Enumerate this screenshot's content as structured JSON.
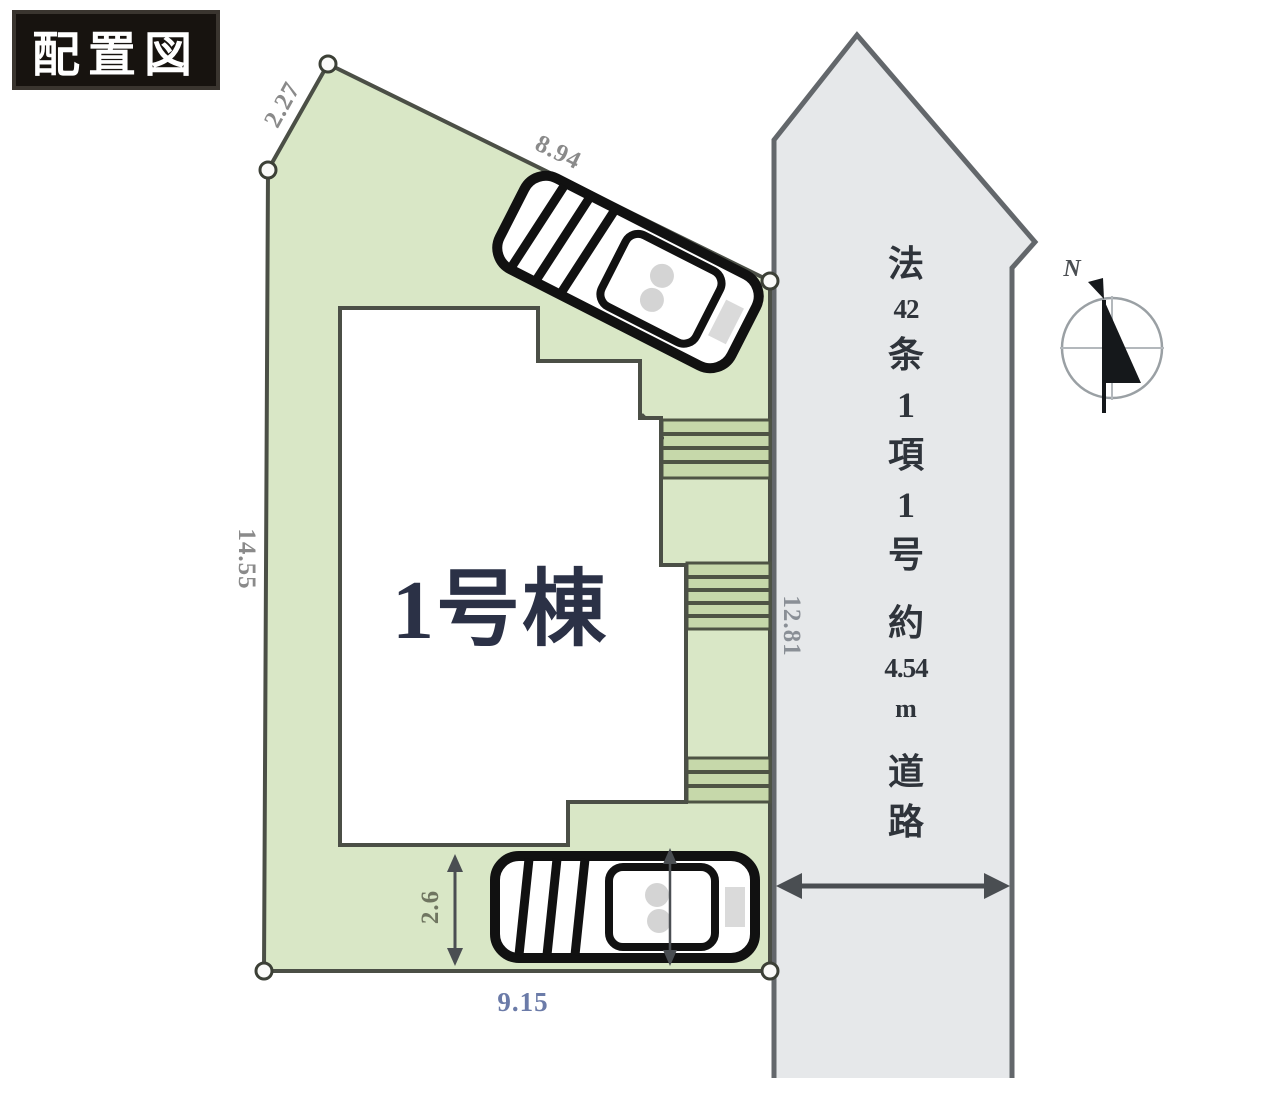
{
  "title": "配置図",
  "plot": {
    "building_label": "1号棟",
    "dimensions": {
      "edge_top_left": "2.27",
      "edge_top": "8.94",
      "edge_left": "14.55",
      "edge_bottom": "9.15",
      "edge_right": "12.81",
      "parking_depth": "2.6"
    }
  },
  "road": {
    "label_full": "法42条1項1号 約4.54m 道路",
    "label_chars": [
      "法",
      "42",
      "条",
      "1",
      "項",
      "1",
      "号",
      "約",
      "4.54",
      "m",
      "道",
      "路"
    ]
  },
  "compass": {
    "north_label": "N"
  },
  "colors": {
    "plot_fill": "#d9e7c6",
    "steps_fill": "#c6d8aa",
    "outline": "#4b4f46",
    "road_fill": "#e6e8ea",
    "road_outline": "#63676b",
    "title_bg": "#17130f",
    "title_text": "#ffffff",
    "dimension_text": "#8a8a8a",
    "bottom_dimension_text": "#6b7ba8",
    "building_text": "#2b3146",
    "car_outline": "#111111"
  }
}
